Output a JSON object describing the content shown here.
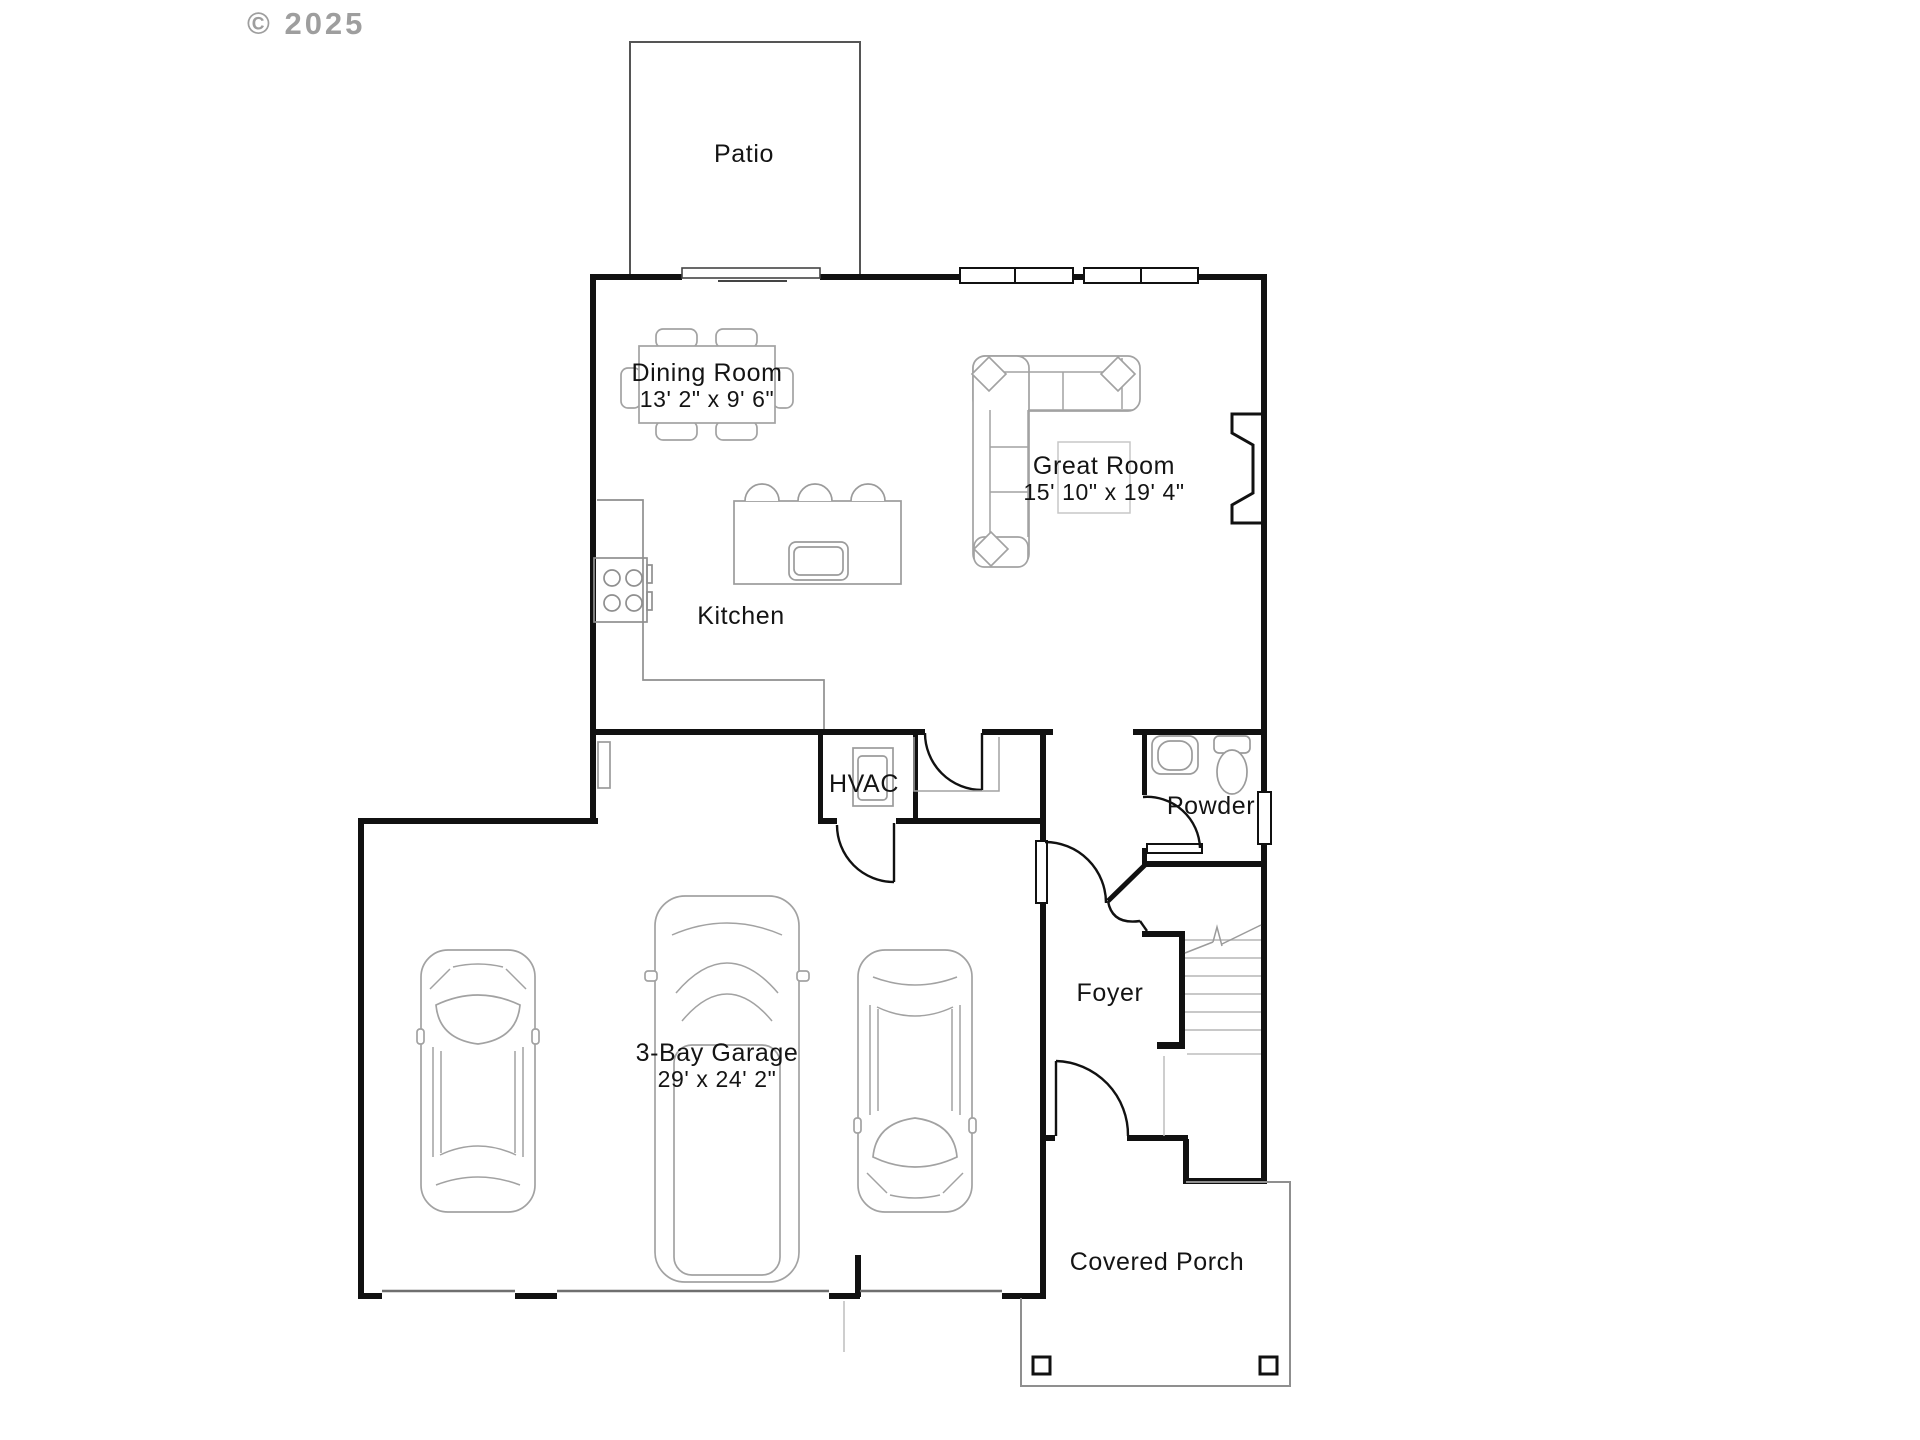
{
  "watermark": {
    "text": "© 2025"
  },
  "rooms": {
    "patio": {
      "label": "Patio"
    },
    "dining": {
      "label": "Dining Room",
      "dims": "13' 2\" x 9' 6\""
    },
    "great": {
      "label": "Great Room",
      "dims": "15' 10\" x 19' 4\""
    },
    "kitchen": {
      "label": "Kitchen"
    },
    "hvac": {
      "label": "HVAC"
    },
    "powder": {
      "label": "Powder"
    },
    "foyer": {
      "label": "Foyer"
    },
    "garage": {
      "label": "3-Bay Garage",
      "dims": "29' x 24' 2\""
    },
    "porch": {
      "label": "Covered Porch"
    }
  },
  "colors": {
    "wall": "#111111",
    "furniture_outline": "#a2a2a2",
    "counter_outline": "#8f8f8f",
    "text": "#141414",
    "watermark": "#8e8e8e",
    "background": "#ffffff"
  }
}
